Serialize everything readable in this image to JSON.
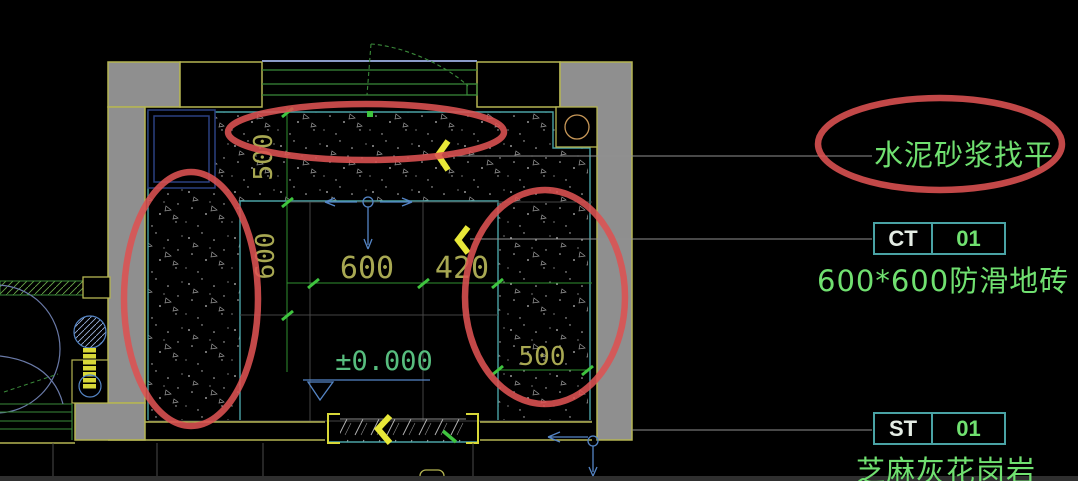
{
  "plan": {
    "dims": {
      "top_band": "500",
      "left_band": "600",
      "tile_main": "600",
      "tile_cut": "420",
      "right_band": "500",
      "level": "±0.000"
    },
    "callouts": {
      "leveling": "水泥砂浆找平",
      "ct_code": "CT",
      "ct_num": "01",
      "ct_desc": "600*600防滑地砖",
      "st_code": "ST",
      "st_num": "01",
      "st_desc": "芝麻灰花岗岩"
    },
    "colors": {
      "wall_fill": "#8f8f8f",
      "wall_line": "#b5b552",
      "floor_line": "#4aa3a5",
      "text_green": "#70e070",
      "dim_text": "#a8a852",
      "marker_yellow": "#e8e838",
      "highlight_red": "#dd5252",
      "leader_blue": "#5585c5"
    }
  }
}
